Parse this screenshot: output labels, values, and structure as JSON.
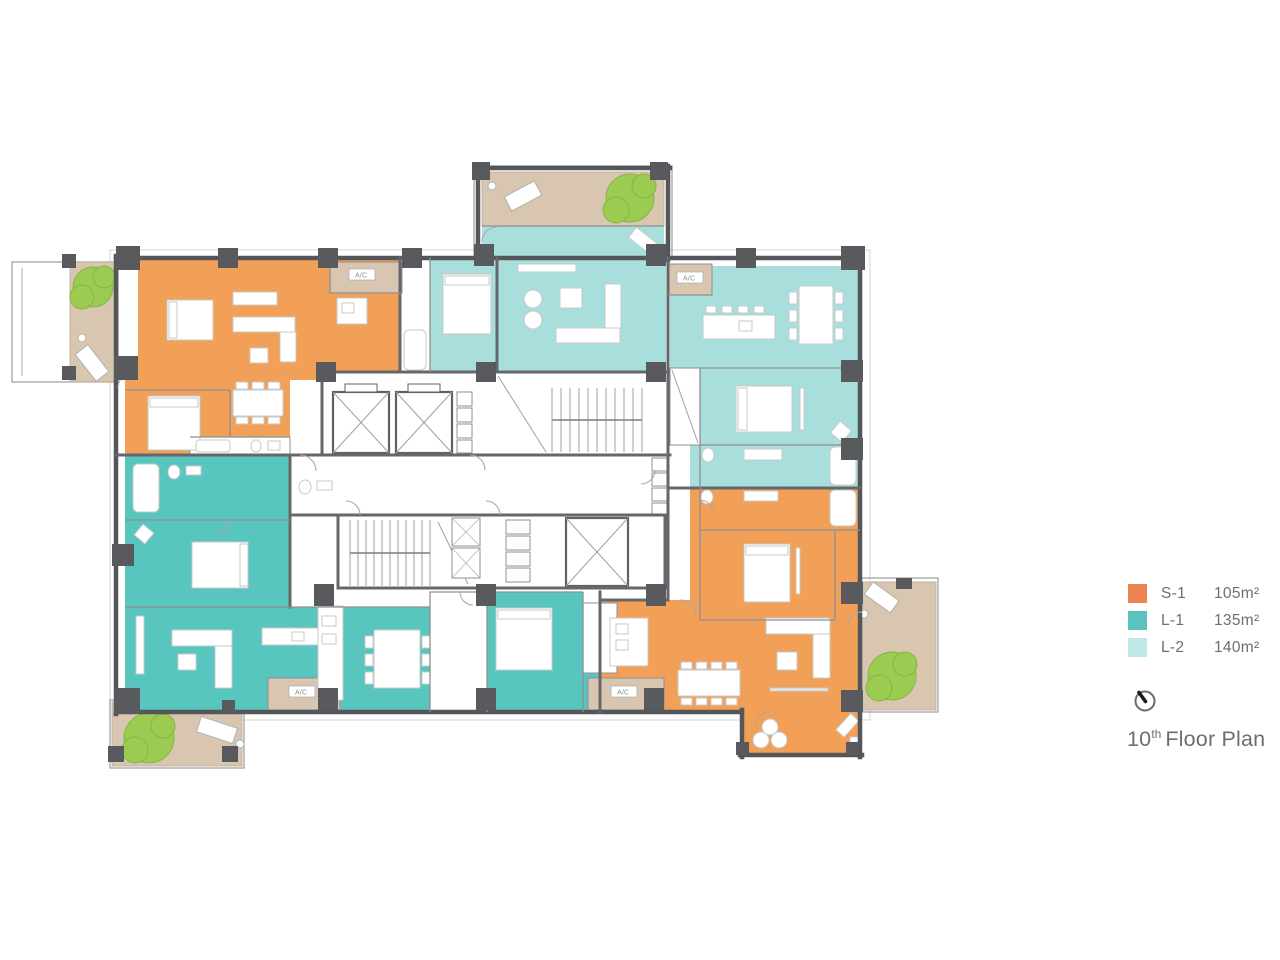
{
  "legend": {
    "items": [
      {
        "code": "S-1",
        "area": "105m²"
      },
      {
        "code": "L-1",
        "area": "135m²"
      },
      {
        "code": "L-2",
        "area": "140m²"
      }
    ]
  },
  "title": {
    "number": "10",
    "suffix": "th",
    "text": "Floor Plan"
  },
  "plan": {
    "ac_label": "A/C"
  },
  "colors": {
    "s1": "#F2A057",
    "l1": "#58C5BE",
    "l2": "#A8DEDC",
    "legend_s1": "#EF8351",
    "legend_l1": "#5BC2BD",
    "legend_l2": "#BDE8E6",
    "balcony": "#D9C6B0",
    "tree": "#9CCB52",
    "wall": "#55565A",
    "text": "#6D6E71"
  }
}
